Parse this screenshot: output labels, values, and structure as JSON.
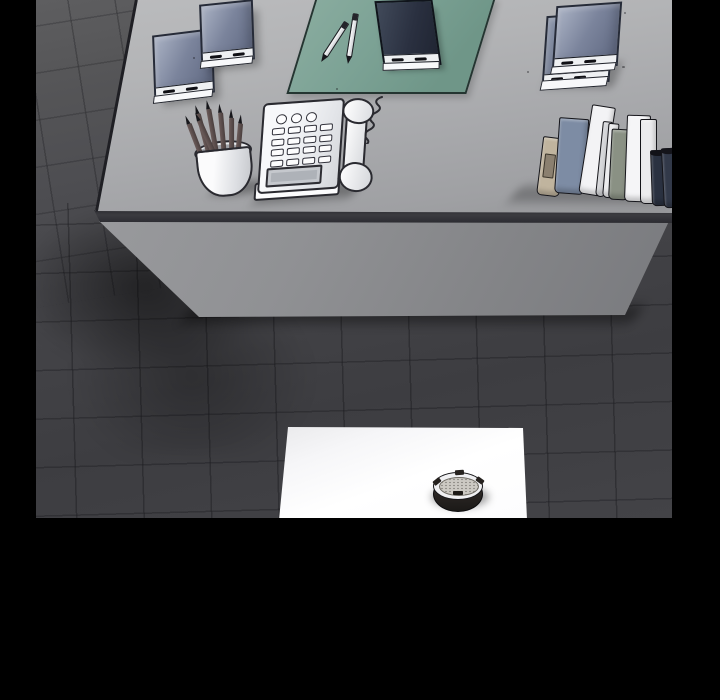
{
  "panel": {
    "description": "Black-framed webtoon panel: high-angle view of a gray office desk on dark tiled floor. On the desk: two slate-blue notebooks, a teal desk mat holding two white pens and a dark memo pad, a cup of pencils, a white push-button telephone with coiled cord and handset, two stacked notebooks and a leaning row of books. Below, a white table with a round ashtray sits on the dark floor.",
    "width": 720,
    "height": 700,
    "scene": {
      "x": 36,
      "y": 0,
      "w": 636,
      "h": 518
    }
  },
  "palette": {
    "frame-black": "#000000",
    "floor-light": "#5e5e60",
    "floor-dark": "#3d3d41",
    "desk-top-light": "#bbbcbe",
    "desk-top-dark": "#96979a",
    "desk-edge": "#2a2a2f",
    "desk-panel-light": "#9b9c9f",
    "desk-panel-dark": "#797a7e",
    "mat-teal": "#7ca295",
    "mat-border": "#243531",
    "notebook-blue-light": "#aab2c4",
    "notebook-blue-dark": "#5e6780",
    "notebook-border": "#262b38",
    "page-white": "#eef0f2",
    "memo-pad-navy": "#2a3040",
    "pencil-brown": "#5a4b49",
    "cup-white": "#fbfbfc",
    "phone-white": "#f7f8fa",
    "phone-outline": "#2a2a30",
    "table-white": "#ffffff",
    "ashtray-dark": "#282422",
    "ashtray-rim": "#f0f0f2",
    "ashtray-dish": "#ccc9c3"
  },
  "objects": [
    "desk",
    "desk-mat",
    "pen-left",
    "pen-right",
    "memo-pad",
    "notebook-left",
    "notebook-right",
    "stacked-notebooks",
    "pencil-cup",
    "telephone",
    "book-row",
    "white-table",
    "ashtray"
  ],
  "books": [
    {
      "x": 8,
      "w": 21,
      "top": 42,
      "h": 57,
      "lean": 7,
      "color": "#c0b49e",
      "kind": "bookend"
    },
    {
      "x": 26,
      "w": 28,
      "top": 23,
      "h": 74,
      "lean": 4,
      "color": "#7d8ca4"
    },
    {
      "x": 50,
      "w": 22,
      "top": 10,
      "h": 88,
      "lean": 9,
      "color": "#f3f3f5"
    },
    {
      "x": 67,
      "w": 8,
      "top": 26,
      "h": 74,
      "lean": 6,
      "color": "#d8d9dc"
    },
    {
      "x": 74,
      "w": 9,
      "top": 28,
      "h": 73,
      "lean": 5,
      "color": "#eeeef0"
    },
    {
      "x": 80,
      "w": 18,
      "top": 34,
      "h": 69,
      "lean": 3,
      "color": "#8a9184"
    },
    {
      "x": 96,
      "w": 22,
      "top": 20,
      "h": 85,
      "lean": 2,
      "color": "#f5f5f7"
    },
    {
      "x": 112,
      "w": 15,
      "top": 24,
      "h": 83,
      "lean": 0,
      "color": "#ececee"
    },
    {
      "x": 124,
      "w": 15,
      "top": 55,
      "h": 54,
      "lean": -2,
      "color": "#2a3140",
      "cap": "#121218"
    },
    {
      "x": 136,
      "w": 14,
      "top": 53,
      "h": 58,
      "lean": -3,
      "color": "#323949",
      "cap": "#14141a"
    },
    {
      "x": 148,
      "w": 12,
      "top": 64,
      "h": 50,
      "lean": -4,
      "color": "#c2b8bc",
      "cap": "#6b6266"
    },
    {
      "x": 157,
      "w": 13,
      "top": 22,
      "h": 95,
      "lean": -4,
      "color": "#17171c",
      "cap": "#e8e8ea"
    },
    {
      "x": 168,
      "w": 12,
      "top": 30,
      "h": 88,
      "lean": -5,
      "color": "#f0f0f2"
    }
  ],
  "pencils": [
    {
      "x": 2,
      "angle": -15,
      "h": 52
    },
    {
      "x": 8,
      "angle": -9,
      "h": 60
    },
    {
      "x": 14,
      "angle": -4,
      "h": 63
    },
    {
      "x": 20,
      "angle": 1,
      "h": 58
    },
    {
      "x": 26,
      "angle": 6,
      "h": 52
    },
    {
      "x": 31,
      "angle": 11,
      "h": 46
    },
    {
      "x": 16,
      "angle": -18,
      "h": 55
    }
  ],
  "phone": {
    "round_buttons": 3,
    "key_rows": 4,
    "key_cols": 4
  }
}
